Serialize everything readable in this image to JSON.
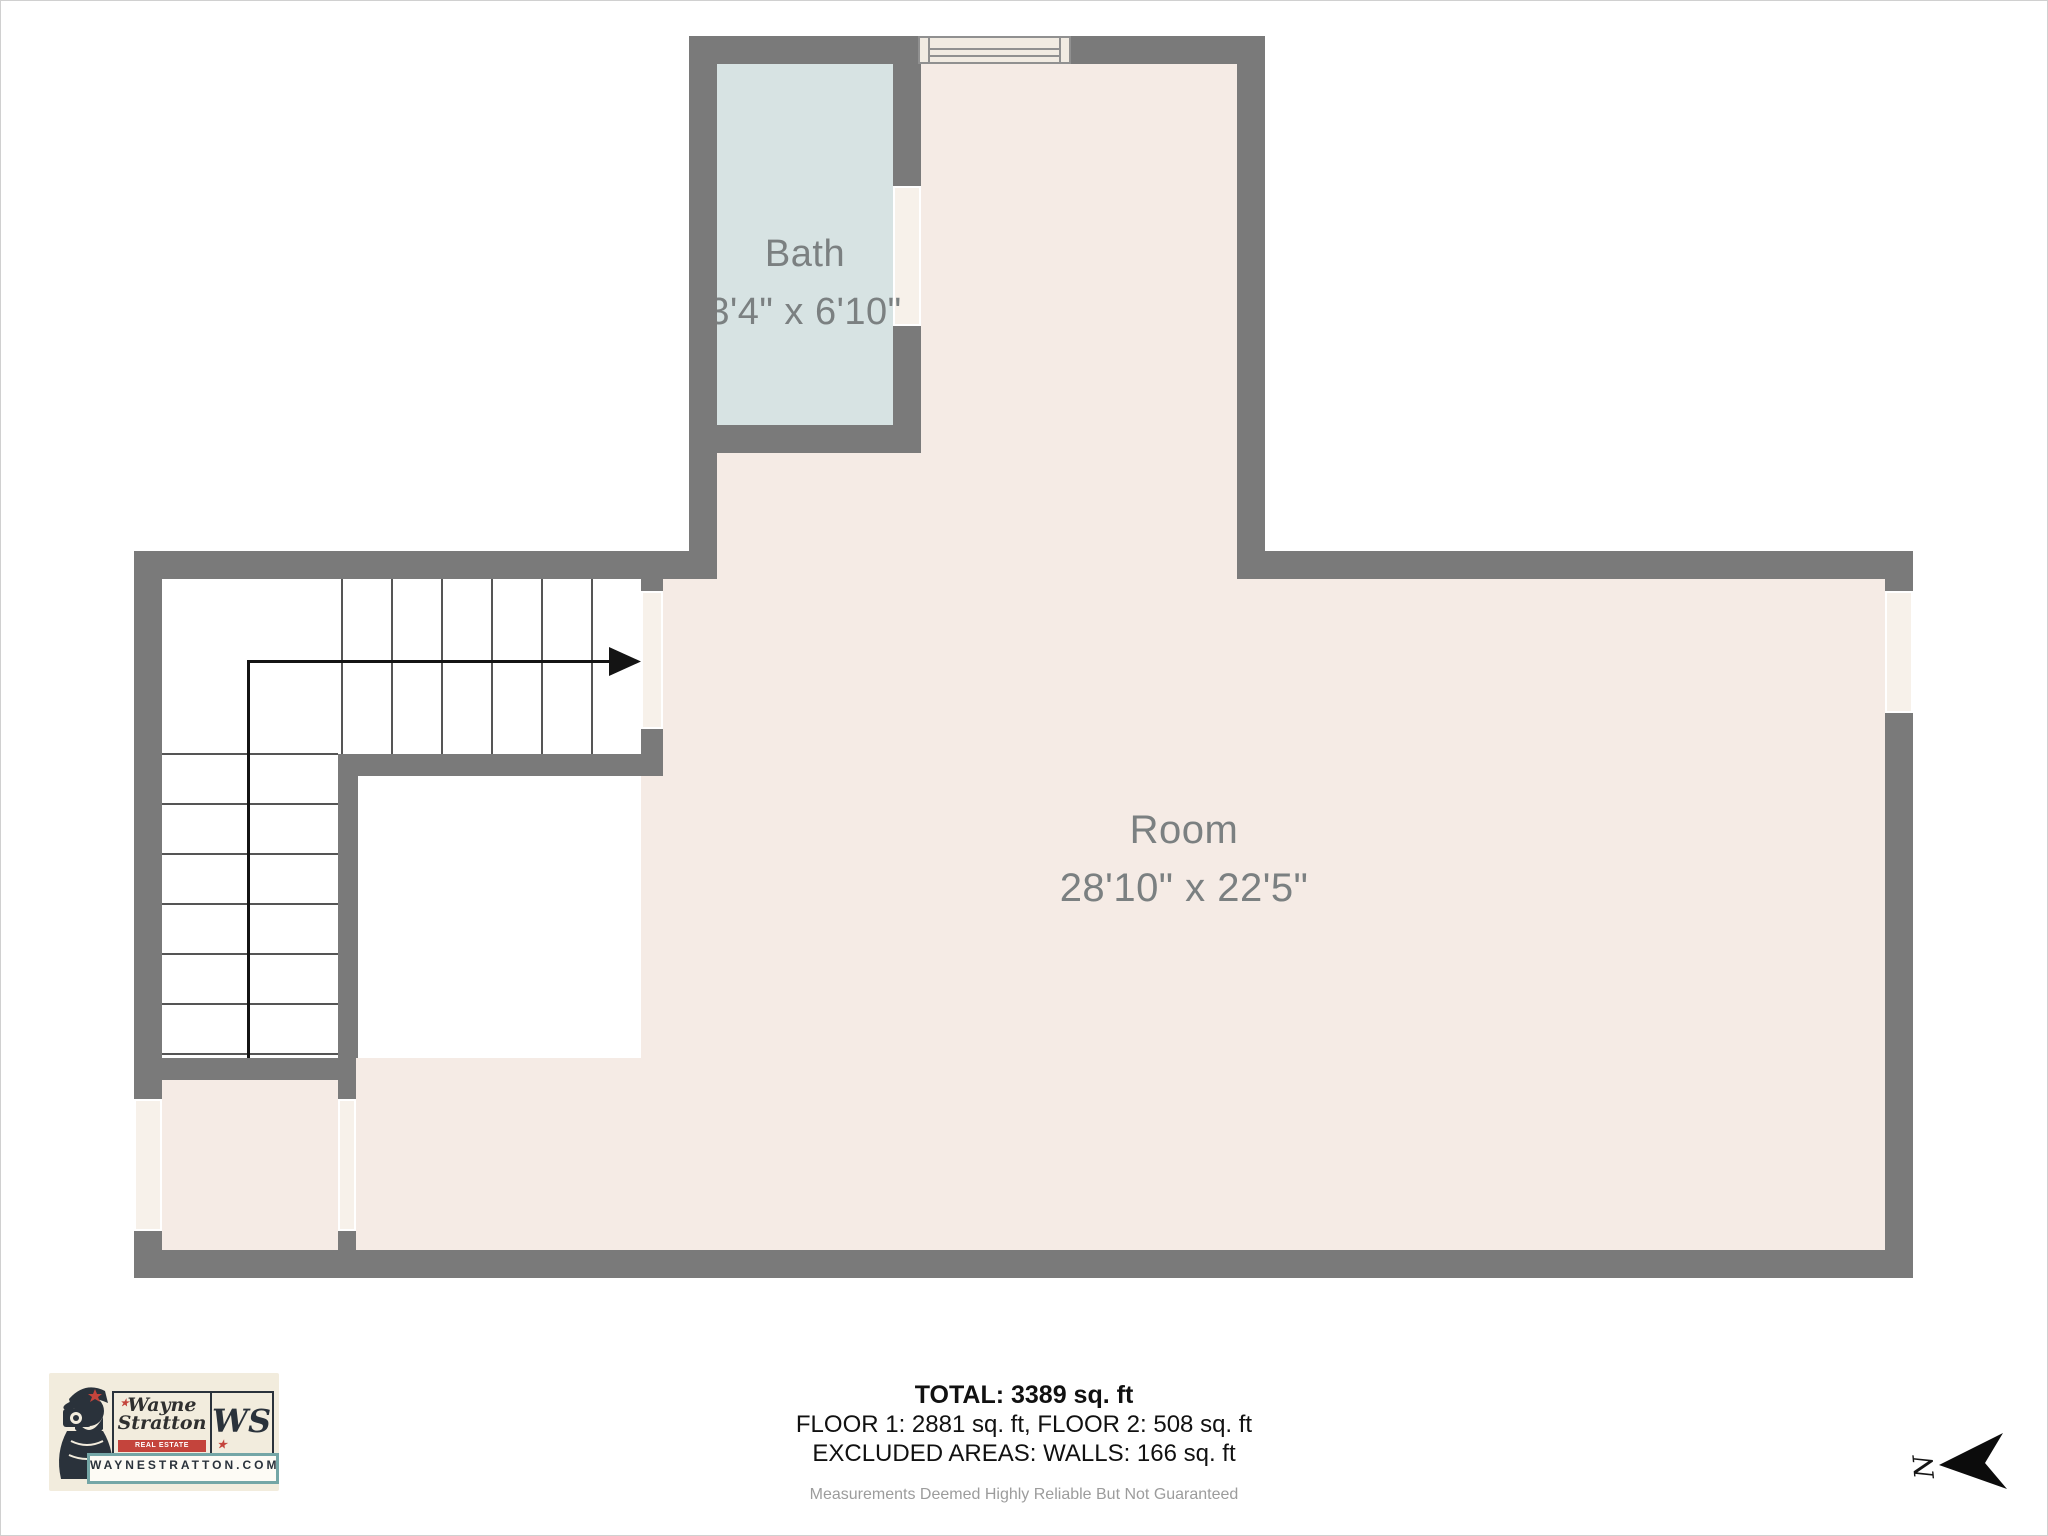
{
  "rooms": {
    "bath": {
      "label": "Bath",
      "dimensions": "3'4\" x 6'10\""
    },
    "main": {
      "label": "Room",
      "dimensions": "28'10\" x 22'5\""
    }
  },
  "summary": {
    "total": "TOTAL: 3389 sq. ft",
    "floors": "FLOOR 1: 2881 sq. ft, FLOOR 2: 508 sq. ft",
    "excluded": "EXCLUDED AREAS: WALLS: 166 sq. ft",
    "disclaimer": "Measurements Deemed Highly Reliable But Not Guaranteed"
  },
  "logo": {
    "name_line1": "Wayne",
    "name_line2": "Stratton",
    "tagline": "REAL ESTATE PHOTOGRAPHY",
    "monogram": "WS",
    "website": "WAYNESTRATTON.COM"
  },
  "compass": {
    "letter": "N"
  },
  "icons": {
    "star": "★"
  },
  "colors": {
    "wall": "#7a7a7a",
    "room_fill": "#f5ebe5",
    "bath_fill": "#d7e3e3",
    "opening_fill": "#f7f1ea",
    "stair_line": "#555555",
    "path_line": "#141414",
    "label_text": "#7b8081",
    "summary_text": "#111111",
    "disclaimer_text": "#9c9c9c",
    "logo_bg": "#f2ecdd",
    "logo_ink": "#2a323b",
    "logo_red": "#c4443c",
    "logo_teal": "#74a6a6"
  }
}
